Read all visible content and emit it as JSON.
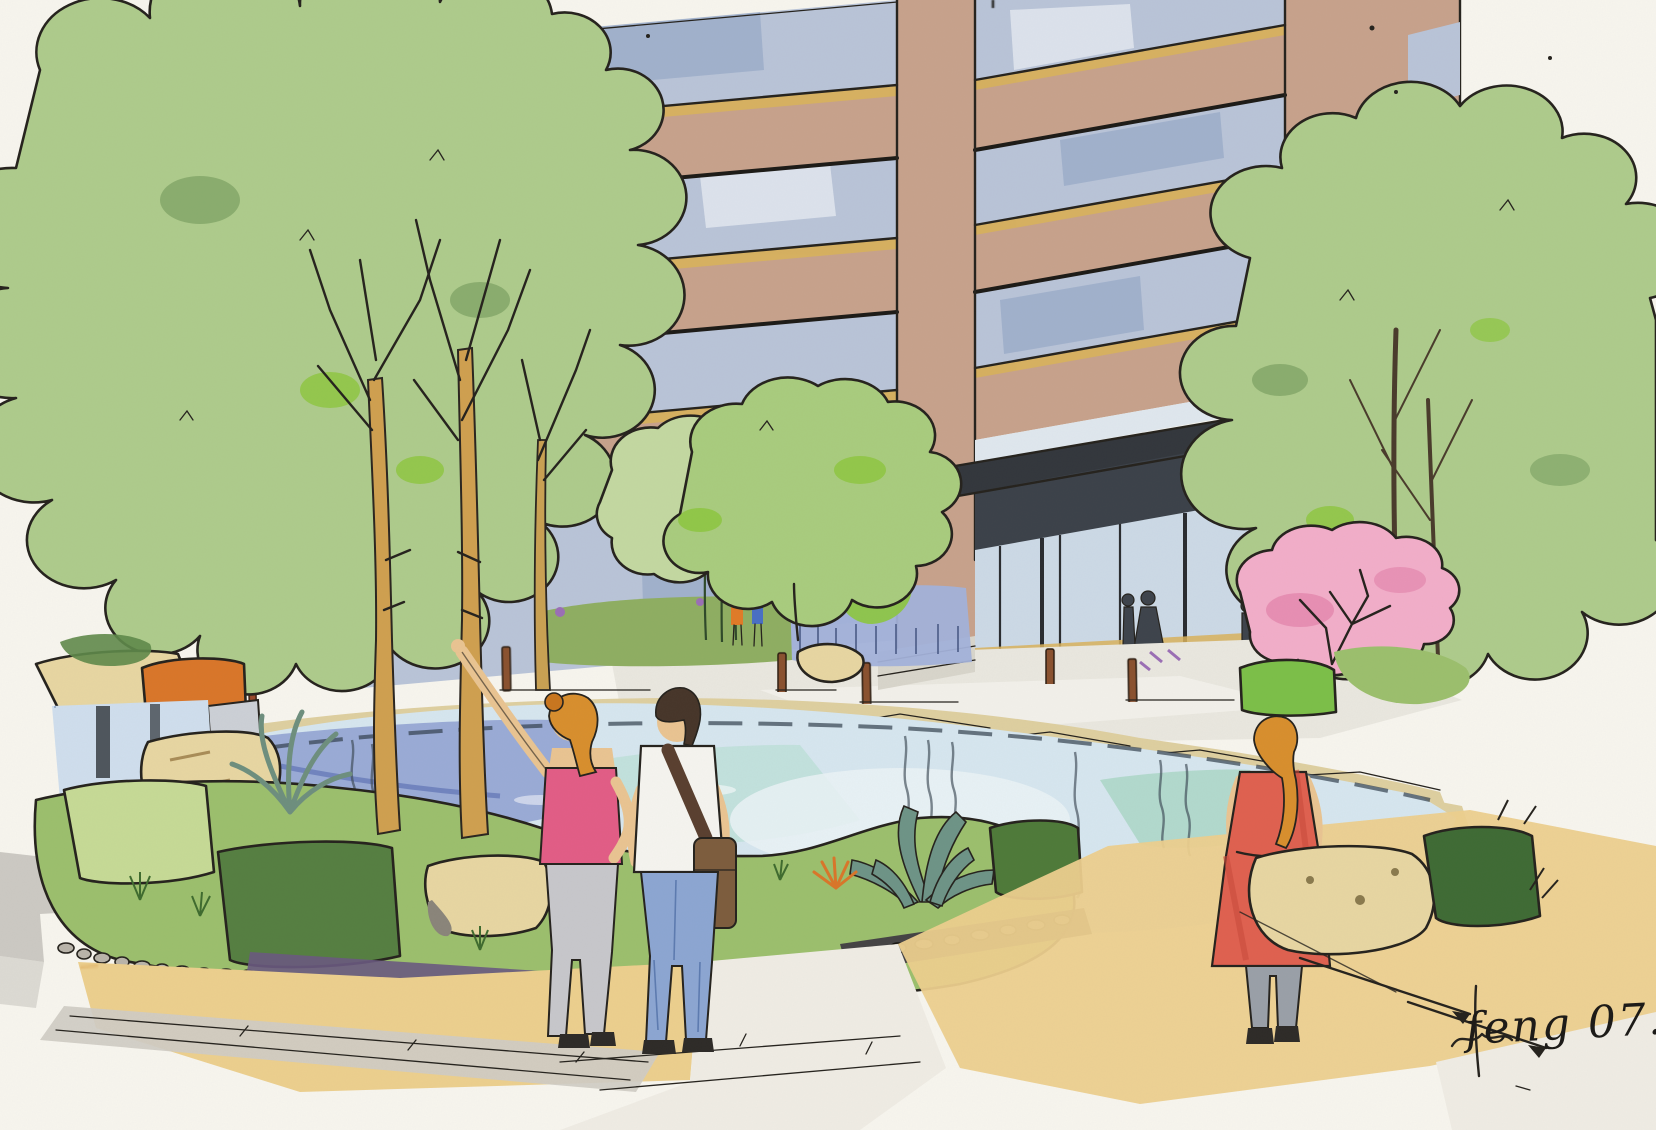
{
  "artwork": {
    "title": "Courtyard garden perspective sketch",
    "medium": "ink, marker and colored-pencil rendering",
    "signature": "feng 07. 4.",
    "scene": {
      "building": "high-rise facade with ribbon windows and glass entrance lobby",
      "entrance": "dark louvered canopy over glass lobby with pedestrian silhouettes",
      "water": "central pond fed by a rock waterfall at left",
      "planting": "tree canopies, pink blossom tree, agave, orange shrub, timber-post edging",
      "people": "woman in pink top pointing, man with shoulder bag, woman in red dress"
    }
  },
  "palette": {
    "paper": "#f7f5ee",
    "ink": "#26231e",
    "facade_tan": "#c7a28c",
    "window_glass": "#b9c4d8",
    "window_shade": "#8ea3c2",
    "ochre": "#d8b25c",
    "canopy_dark": "#33373d",
    "louver_zone": "#3c424a",
    "entrance_glass": "#ccd9e6",
    "tree_green": "#aecb8c",
    "tree_green_light": "#c3d8a1",
    "tree_green_mid": "#a9cc7e",
    "tree_accent": "#8dc63f",
    "tree_dark": "#5f8a4a",
    "grass_green": "#9cbf6d",
    "blossom_pink": "#f2aec9",
    "blossom_deep": "#e487ae",
    "water": "#d6e6ef",
    "water_periwinkle": "#8b9ccf",
    "water_aqua": "#b9ded6",
    "stone_cream": "#decfa0",
    "rock_cream": "#e7d6a2",
    "timber_brown": "#8a5230",
    "paving_tan": "#eccf8e",
    "paving_gray": "#cfccc4",
    "paving_white": "#efece4",
    "shadow_purple": "#584a6e",
    "skin": "#e9c492",
    "hair_orange": "#d88f2e",
    "hair_brown": "#47362a",
    "top_pink": "#e25d86",
    "shirt_white": "#f5f4ef",
    "jeans_blue": "#8ca6d2",
    "pants_gray": "#c7c7cb",
    "dress_red": "#df6150",
    "bag_brown": "#7d5d3e",
    "silhouette": "#3e444c",
    "accent_blue": "#4a6fc4",
    "accent_orange": "#e07b28",
    "accent_purple": "#9b6fb5"
  }
}
